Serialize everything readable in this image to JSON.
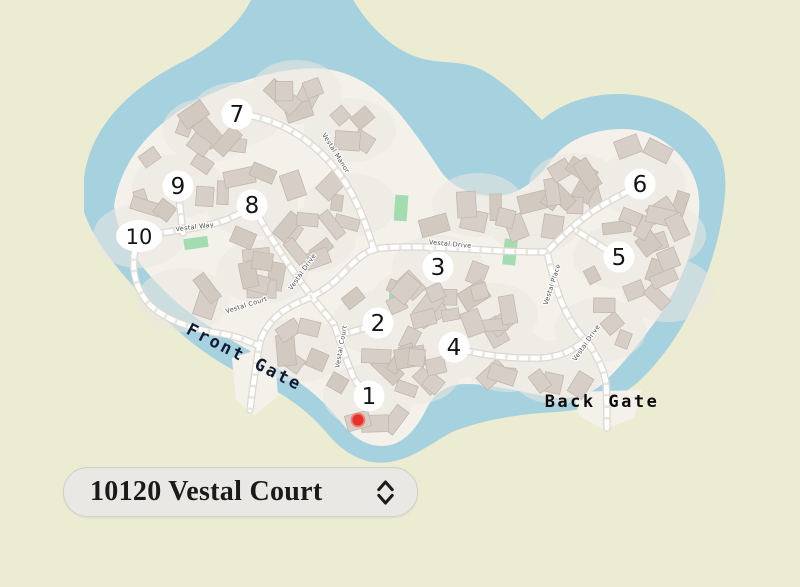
{
  "colors": {
    "outer_land": "#ebecd1",
    "water": "#a6d1df",
    "community_land": "#f4f1ea",
    "ground_patch": "#ebe7e1",
    "building_fill": "#d7cfc7",
    "building_fill_alt": "#d2c9c0",
    "building_stroke": "#c2b7ad",
    "road_fill": "#ffffff",
    "road_casing": "#dcd8d1",
    "road_dash": "#e7e3dc",
    "green_space": "#a3dcb0",
    "street_label_text": "#4c4c4c",
    "marker_halo": "#ffffff",
    "marker_text": "#141414",
    "selected_dot": "#e5332a",
    "selected_dot_ring": "#ef8078",
    "front_gate_text": "#0e1c33",
    "back_gate_text": "#0c0c0c",
    "selector_bg": "#e9e8e5",
    "selector_border": "#d2cfc9",
    "selector_text": "#1a1a1a"
  },
  "map": {
    "lot_markers": [
      {
        "label": "1",
        "x": 369,
        "y": 396
      },
      {
        "label": "2",
        "x": 378,
        "y": 323
      },
      {
        "label": "3",
        "x": 438,
        "y": 267
      },
      {
        "label": "4",
        "x": 454,
        "y": 347
      },
      {
        "label": "5",
        "x": 619,
        "y": 257
      },
      {
        "label": "6",
        "x": 640,
        "y": 184
      },
      {
        "label": "7",
        "x": 237,
        "y": 114
      },
      {
        "label": "8",
        "x": 252,
        "y": 205
      },
      {
        "label": "9",
        "x": 178,
        "y": 186
      },
      {
        "label": "10",
        "x": 139,
        "y": 236,
        "wide": true
      }
    ],
    "street_labels": [
      {
        "name": "Vestal Manor",
        "x": 334,
        "y": 154,
        "rotate": 58
      },
      {
        "name": "Vestal Way",
        "x": 195,
        "y": 229,
        "rotate": -7
      },
      {
        "name": "Vestal Drive",
        "x": 450,
        "y": 246,
        "rotate": 5
      },
      {
        "name": "Vestal Drive",
        "x": 304,
        "y": 273,
        "rotate": -55
      },
      {
        "name": "Vestal Court",
        "x": 247,
        "y": 307,
        "rotate": -17
      },
      {
        "name": "Vestal Court",
        "x": 343,
        "y": 347,
        "rotate": -80
      },
      {
        "name": "Vestal Place",
        "x": 554,
        "y": 285,
        "rotate": -72
      },
      {
        "name": "Vestal Drive",
        "x": 588,
        "y": 344,
        "rotate": -55
      }
    ],
    "gate_labels": [
      {
        "id": "front-gate",
        "label": "Front Gate",
        "x": 242,
        "y": 362,
        "rotate": 27
      },
      {
        "id": "back-gate",
        "label": "Back Gate",
        "x": 602,
        "y": 407,
        "rotate": 0
      }
    ],
    "green_spaces": [
      {
        "x": 196,
        "y": 243,
        "w": 24,
        "h": 11,
        "rotate": -8
      },
      {
        "x": 401,
        "y": 208,
        "w": 13,
        "h": 26,
        "rotate": 4
      },
      {
        "x": 510,
        "y": 252,
        "w": 13,
        "h": 26,
        "rotate": 6
      },
      {
        "x": 394,
        "y": 298,
        "w": 10,
        "h": 15,
        "rotate": 4
      }
    ],
    "selected_location": {
      "x": 358,
      "y": 420
    }
  },
  "address_selector": {
    "value": "10120 Vestal Court",
    "icon": "up-down-chevron"
  }
}
